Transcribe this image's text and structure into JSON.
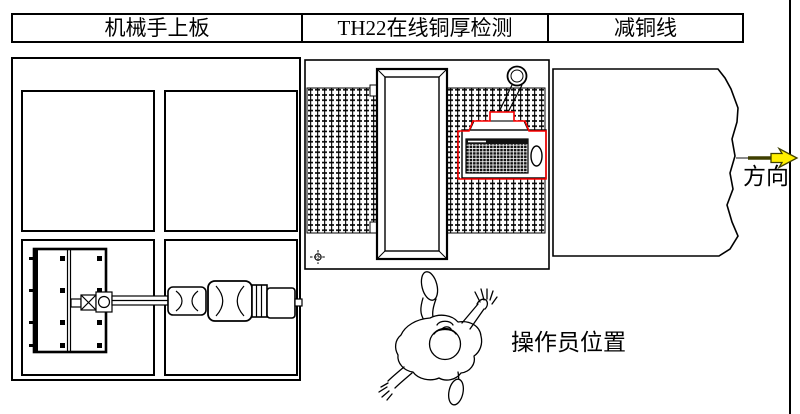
{
  "diagram": {
    "title_sections": [
      {
        "id": "robot-loading",
        "label": "机械手上板"
      },
      {
        "id": "th22-detection",
        "label": "TH22在线铜厚检测"
      },
      {
        "id": "copper-reduction",
        "label": "减铜线"
      }
    ],
    "labels": {
      "direction": "方向",
      "operator_position": "操作员位置"
    },
    "colors": {
      "line": "#000000",
      "console_highlight": "#ff0000",
      "arrow_fill": "#ffef00",
      "arrow_outline": "#3f3f00"
    },
    "icons": [
      "hook-circle-icon",
      "datum-crosshair-icon",
      "flow-arrow-icon"
    ]
  }
}
